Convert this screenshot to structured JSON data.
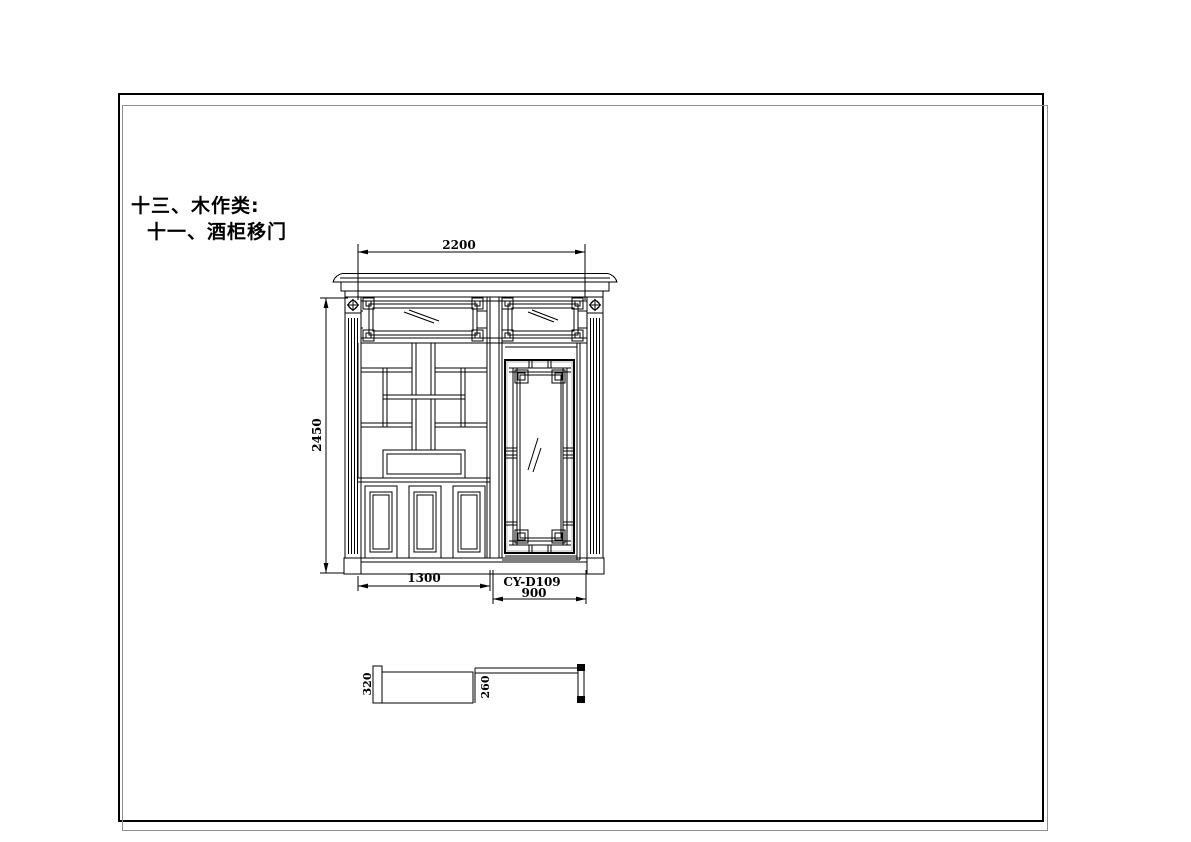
{
  "titles": {
    "line1": "十三、木作类:",
    "line2": "十一、酒柜移门"
  },
  "drawing": {
    "door_code": "CY-D109",
    "dim_overall_width": "2200",
    "dim_overall_height": "2450",
    "dim_cabinet_width": "1300",
    "dim_door_width": "900",
    "dim_cabinet_depth": "320",
    "dim_door_depth": "260"
  },
  "colors": {
    "line": "#000000",
    "frame_border": "#000000",
    "frame_shadow": "#8f8f8f",
    "glass_shadow": "#b5b5b5",
    "background": "#ffffff"
  }
}
